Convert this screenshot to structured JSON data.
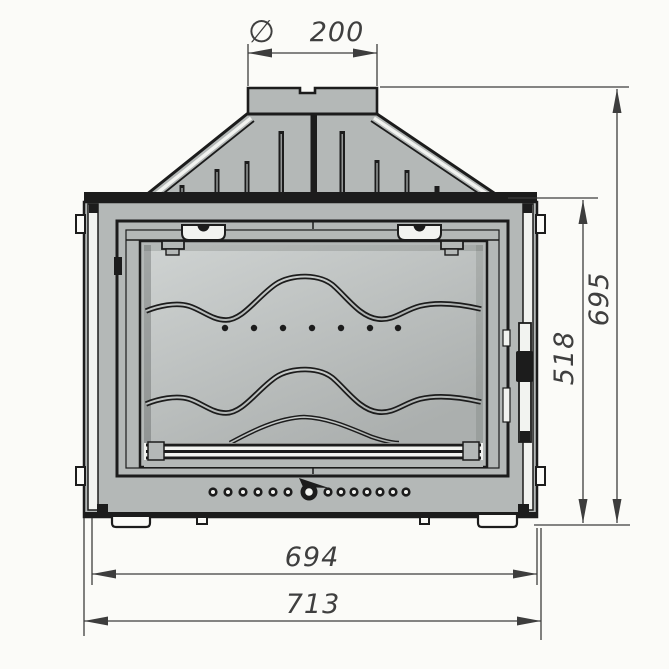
{
  "drawing": {
    "name": "fireplace-insert-front-elevation",
    "colors": {
      "paper": "#fbfbf8",
      "metal": "#b4b8b7",
      "glass_light": "#cfd3d2",
      "glass_dark": "#abafae",
      "line": "#1c1c1c",
      "dim_line": "#3d3d3d",
      "text": "#3f3f3f",
      "white_detail": "#f2f3f0"
    },
    "dimensions": {
      "flue": {
        "symbol": "∅",
        "value": "200"
      },
      "overall_height": {
        "value": "695"
      },
      "firebox_height": {
        "value": "518"
      },
      "body_width": {
        "value": "694"
      },
      "overall_width": {
        "value": "713"
      }
    }
  }
}
